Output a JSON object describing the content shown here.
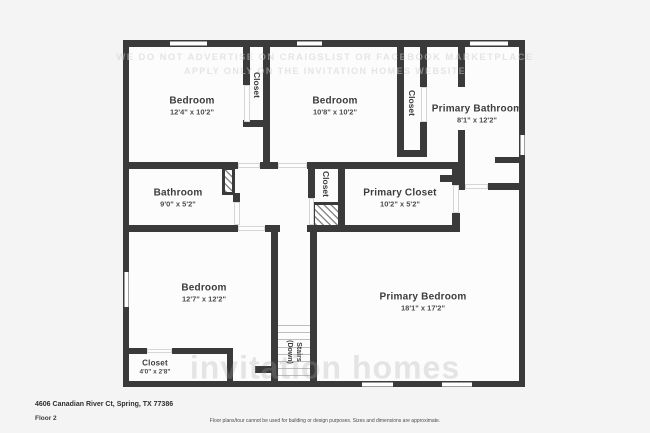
{
  "watermark": {
    "line1": "WE DO NOT ADVERTISE ON CRAIGSLIST OR FACEBOOK MARKETPLACE",
    "line2": "APPLY ONLY ON THE INVITATION HOMES WEBSITE",
    "brand": "invitation homes"
  },
  "rooms": {
    "bedroom1": {
      "name": "Bedroom",
      "dims": "12'4\" x 10'2\""
    },
    "bedroom2": {
      "name": "Bedroom",
      "dims": "10'8\" x 10'2\""
    },
    "primary_bathroom": {
      "name": "Primary Bathroom",
      "dims": "8'1\" x 12'2\""
    },
    "bathroom": {
      "name": "Bathroom",
      "dims": "9'0\" x 5'2\""
    },
    "primary_closet": {
      "name": "Primary Closet",
      "dims": "10'2\" x 5'2\""
    },
    "bedroom3": {
      "name": "Bedroom",
      "dims": "12'7\" x 12'2\""
    },
    "primary_bedroom": {
      "name": "Primary Bedroom",
      "dims": "18'1\" x 17'2\""
    },
    "closet_small": {
      "name": "Closet",
      "dims": "4'0\" x 2'8\""
    },
    "closet_top_left": {
      "name": "Closet"
    },
    "closet_top_right": {
      "name": "Closet"
    },
    "closet_middle": {
      "name": "Closet"
    }
  },
  "stairs": {
    "line1": "Stairs",
    "line2": "(Down)"
  },
  "footer": {
    "address": "4606 Canadian River Ct, Spring, TX 77386",
    "floor_label": "Floor 2",
    "disclaimer": "Floor plans/tour cannot be used for building or design purposes. Sizes and dimensions are approximate."
  }
}
